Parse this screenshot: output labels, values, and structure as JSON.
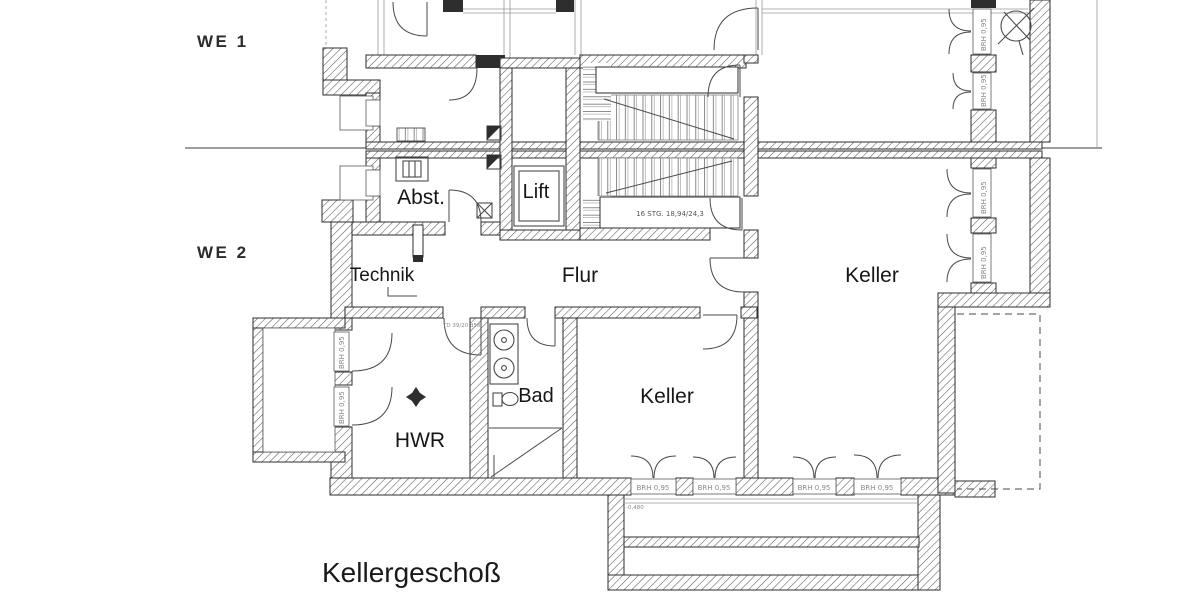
{
  "title": "Kellergeschoß",
  "units": {
    "we1": "WE 1",
    "we2": "WE 2"
  },
  "rooms": {
    "abst": "Abst.",
    "lift": "Lift",
    "technik": "Technik",
    "flur": "Flur",
    "keller_right": "Keller",
    "bad": "Bad",
    "keller_center": "Keller",
    "hwr": "HWR"
  },
  "annotations": {
    "stair_note": "16 STG. 18,94/24,3",
    "sill": "BRH 0,95",
    "door_tag": "TD 39/20 d58",
    "level": "-0,480"
  },
  "colors": {
    "background": "#ffffff",
    "ink": "#2e2e2e",
    "hatch": "#5a5a5a",
    "label": "#161616",
    "scan_text": "#555555",
    "dashed_outline": "#8a8a8a"
  }
}
